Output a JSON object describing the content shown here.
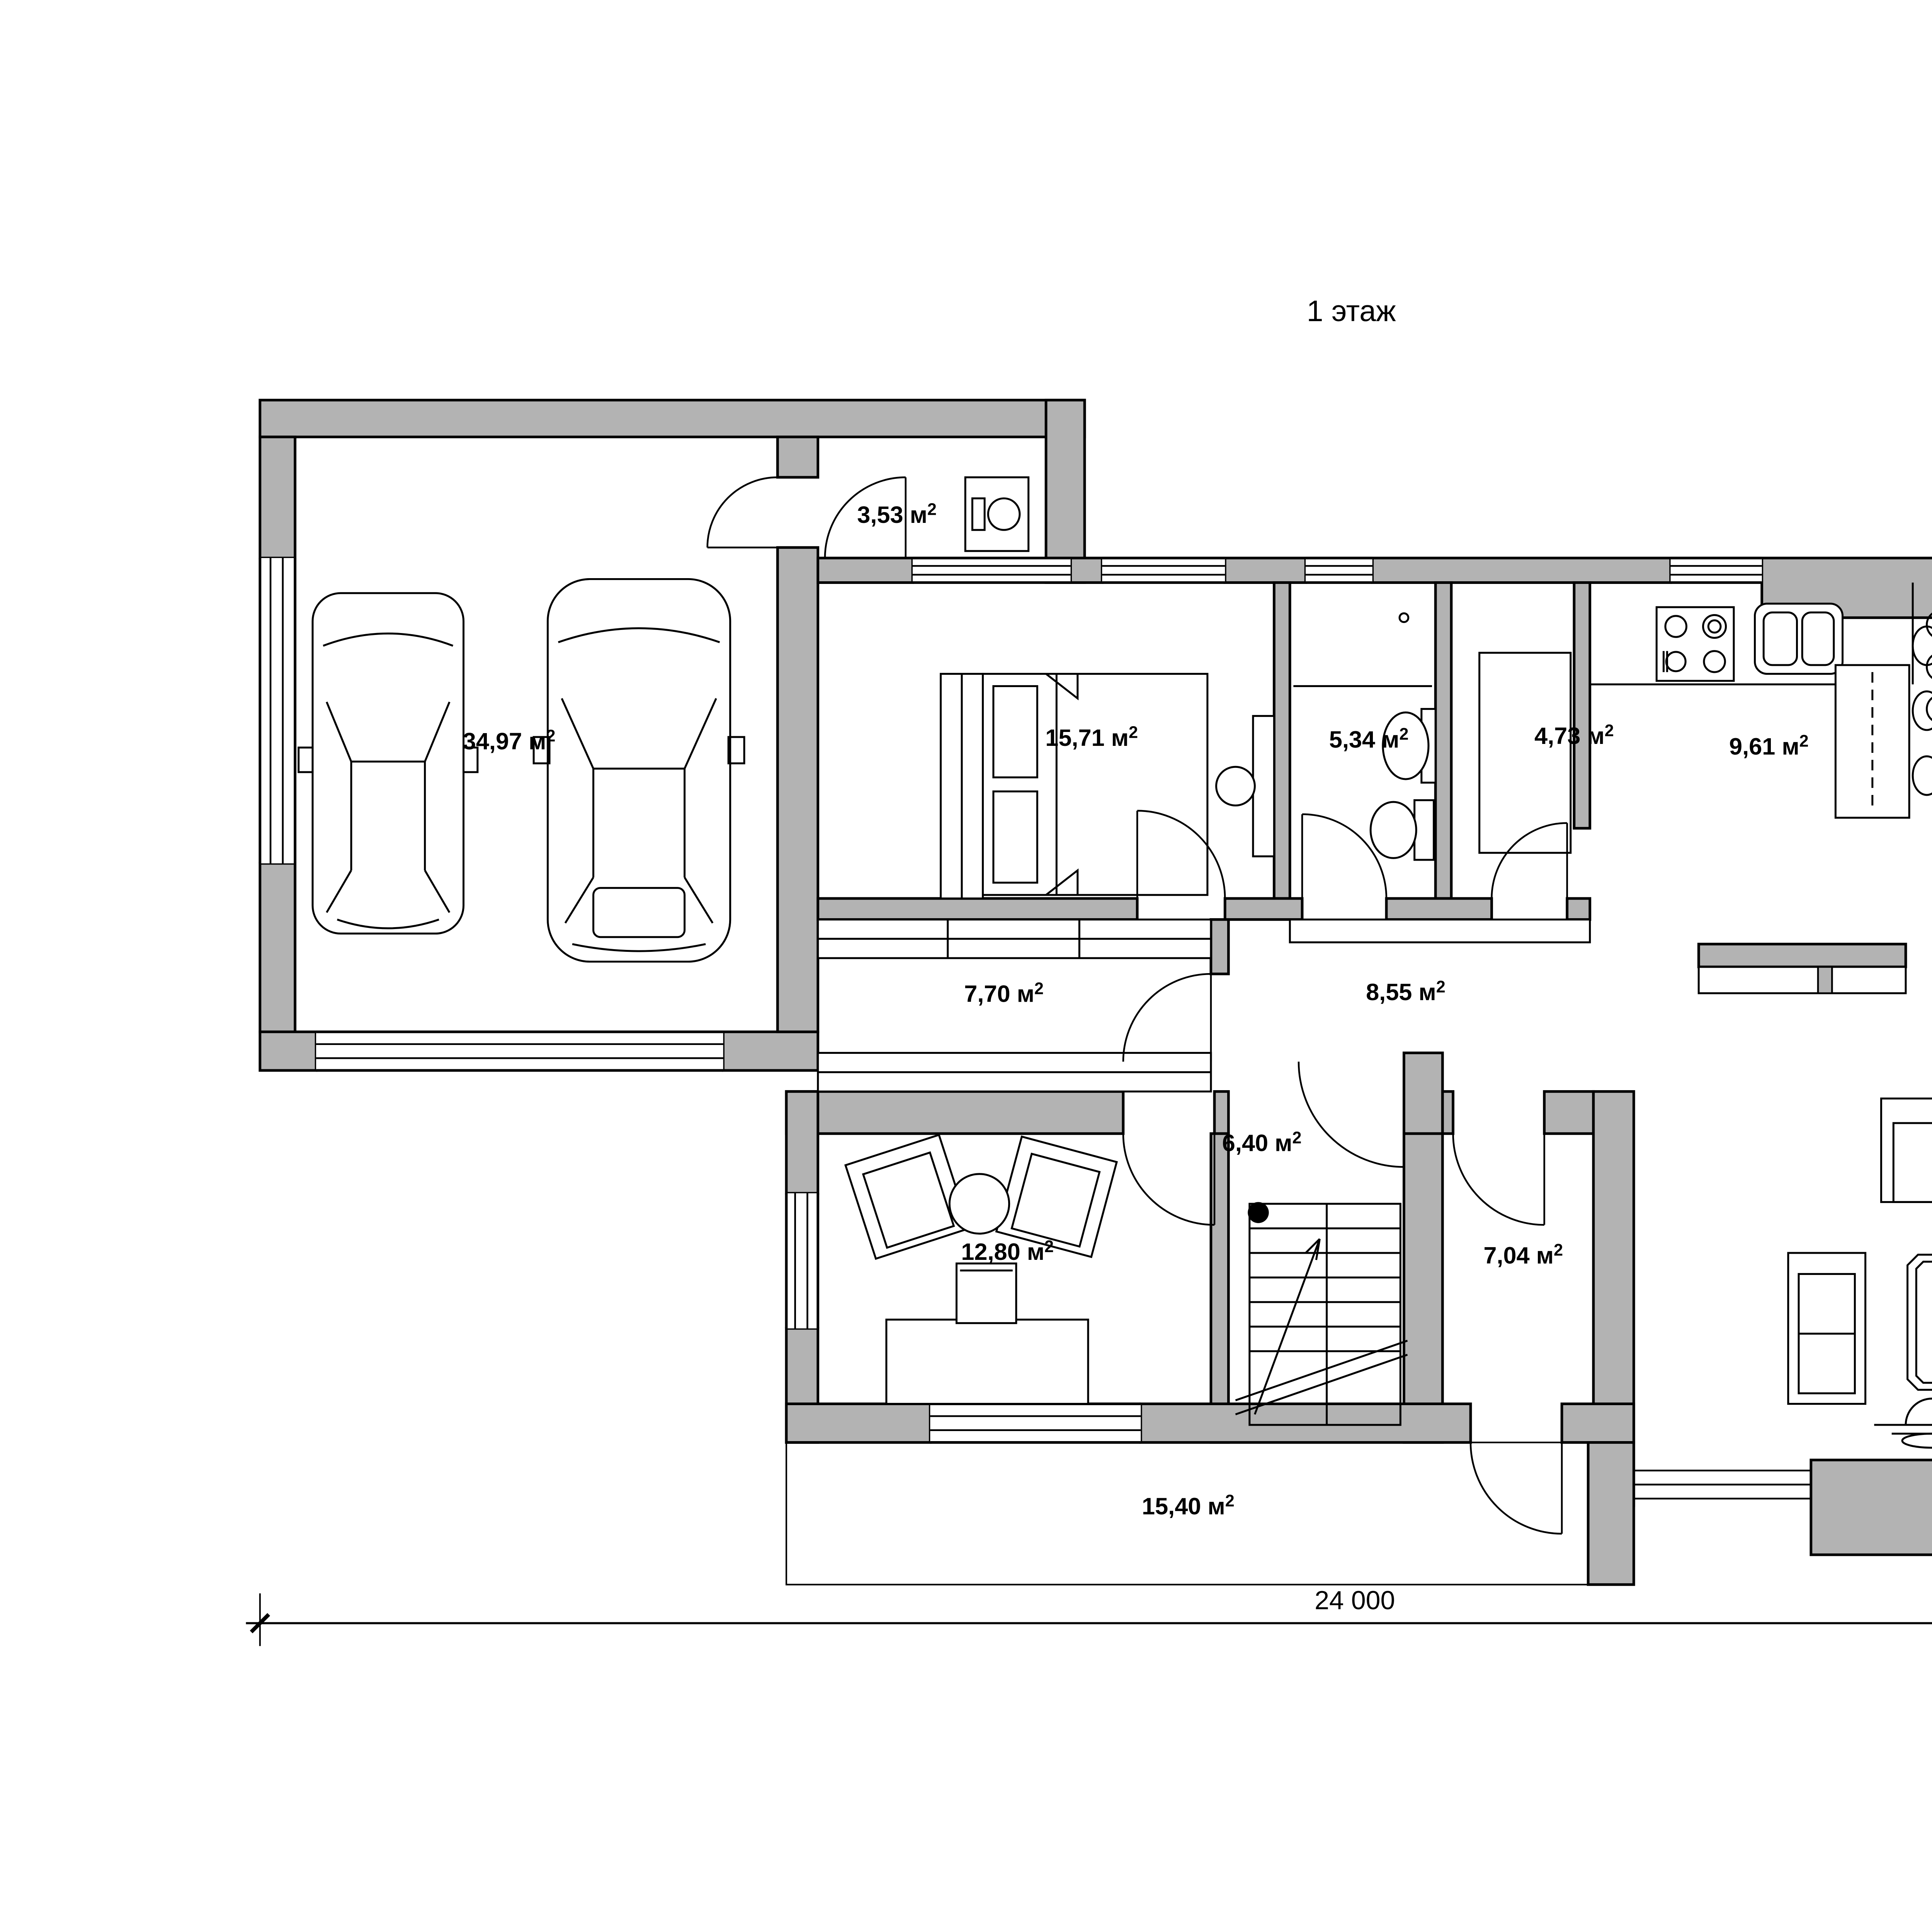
{
  "title": "1 этаж",
  "unit_base": " м",
  "unit_sup": "2",
  "rooms": [
    {
      "id": "garage",
      "value": "34,97"
    },
    {
      "id": "boiler-room",
      "value": "3,53"
    },
    {
      "id": "bedroom",
      "value": "15,71"
    },
    {
      "id": "bathroom",
      "value": "5,34"
    },
    {
      "id": "pantry",
      "value": "4,73"
    },
    {
      "id": "kitchen",
      "value": "9,61"
    },
    {
      "id": "dining-area",
      "value": "26,85"
    },
    {
      "id": "corridor",
      "value": "7,70"
    },
    {
      "id": "hall",
      "value": "8,55"
    },
    {
      "id": "terrace-east",
      "value": "15,11"
    },
    {
      "id": "stair-hall",
      "value": "6,40"
    },
    {
      "id": "study",
      "value": "12,80"
    },
    {
      "id": "entry-hall",
      "value": "7,04"
    },
    {
      "id": "living-room",
      "value": "21,76"
    },
    {
      "id": "terrace-south",
      "value": "15,40"
    }
  ],
  "dimensions": {
    "width_label": "24 000",
    "height_label": "12 800"
  },
  "colors": {
    "wall_fill": "#b3b3b3",
    "line": "#000000",
    "deck_hatch": "#c0c0c0"
  }
}
